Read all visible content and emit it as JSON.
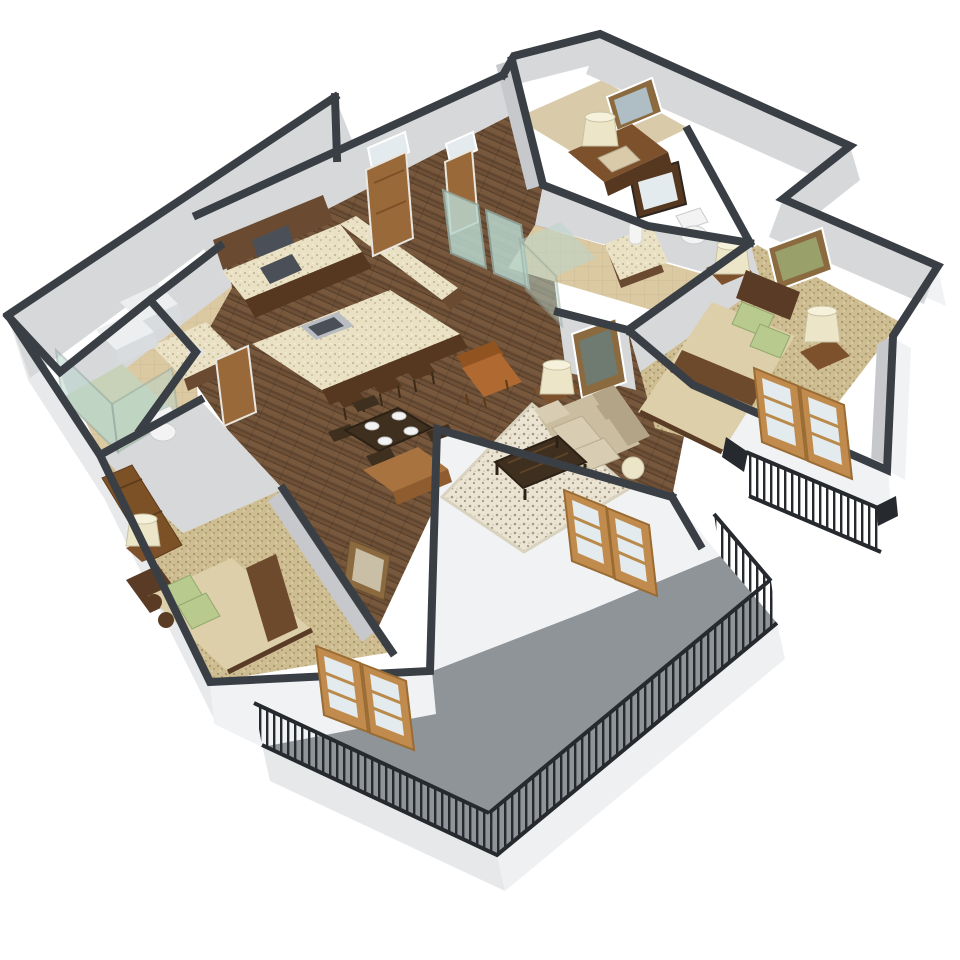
{
  "title": "3D isometric floor plan rendering of a two-bedroom apartment with balcony",
  "palette": {
    "bg": "#ffffff",
    "wallCap": "#3a3f45",
    "wallFace": "#d7d8da",
    "wallFaceDark": "#c6c8cb",
    "wallExt": "#f1f2f4",
    "wallExtShade": "#e7e9eb",
    "woodFloor": "#6e5037",
    "woodFloorDark": "#59402c",
    "woodPlank": "#836143",
    "carpet": "#cfbd92",
    "carpetDot": "#857450",
    "carpet2": "#d9cbaa",
    "tile": "#dbc9a2",
    "balcony": "#8f9498",
    "fascia": "#eff0f2",
    "fascia2": "#e6e8ea",
    "railing": "#26292d",
    "granite": "#eae1c4",
    "graniteDot": "#9c8f6a",
    "cabinet": "#6a4a30",
    "cabinetDark": "#55381f",
    "steel": "#b9bdc2",
    "cooktop": "#4b5058",
    "sofa": "#cabda0",
    "sofaShade": "#b3a487",
    "sofaLight": "#d8cdb2",
    "rug": "#ebe4d3",
    "rugDot": "#5f4f3a",
    "tableDark": "#3f2f1f",
    "consoleWood": "#a9733f",
    "armchair": "#b06a31",
    "armchairDark": "#91531f",
    "bedBlanket": "#dccfa9",
    "bedRunner": "#6d4a2c",
    "pillowGreen": "#b8ca8e",
    "headboard": "#5a3c26",
    "nightstand": "#7d512c",
    "lampShade": "#ece5c8",
    "doorWood": "#99693a",
    "doorWoodDark": "#7d5126",
    "frenchDoor": "#c08b4d",
    "glassPane": "#e3ebee",
    "glassTeal": "#b9d6cd",
    "glassFrame": "#93aaa2",
    "artFrame": "#8a6a3e",
    "artInner": "#c9bfa6",
    "toiletWhite": "#f2f3f2",
    "shadow": "rgba(40,45,50,0.10)"
  },
  "scene": {
    "type": "isometric-floor-plan",
    "view": "3/4 aerial cutaway, walls cut at mid-height with dark caps, white background",
    "rooms": [
      {
        "name": "entry-hall"
      },
      {
        "name": "kitchen"
      },
      {
        "name": "dining-area"
      },
      {
        "name": "living-room"
      },
      {
        "name": "den-nook"
      },
      {
        "name": "master-bathroom"
      },
      {
        "name": "master-bedroom"
      },
      {
        "name": "second-bedroom"
      },
      {
        "name": "second-bathroom"
      },
      {
        "name": "laundry-closet"
      },
      {
        "name": "main-balcony"
      },
      {
        "name": "juliet-balcony"
      }
    ],
    "furniture": [
      "kitchen-island-with-sink",
      "bar-stools",
      "range-counter-with-cooktop",
      "upper-cabinets",
      "dining-table-with-four-place-settings",
      "dining-chairs",
      "console-table",
      "sofa",
      "coffee-table",
      "area-rug",
      "armchair",
      "side-table-lamp",
      "master-bed-with-green-pillows",
      "nightstands-with-lamps",
      "framed-wall-art",
      "guest-bed-with-green-pillows",
      "leaning-framed-art",
      "desk-with-lamp",
      "toilets",
      "vanities",
      "glass-shower",
      "sliding-glass-closet-doors",
      "french-doors",
      "black-metal-balcony-railings"
    ]
  }
}
